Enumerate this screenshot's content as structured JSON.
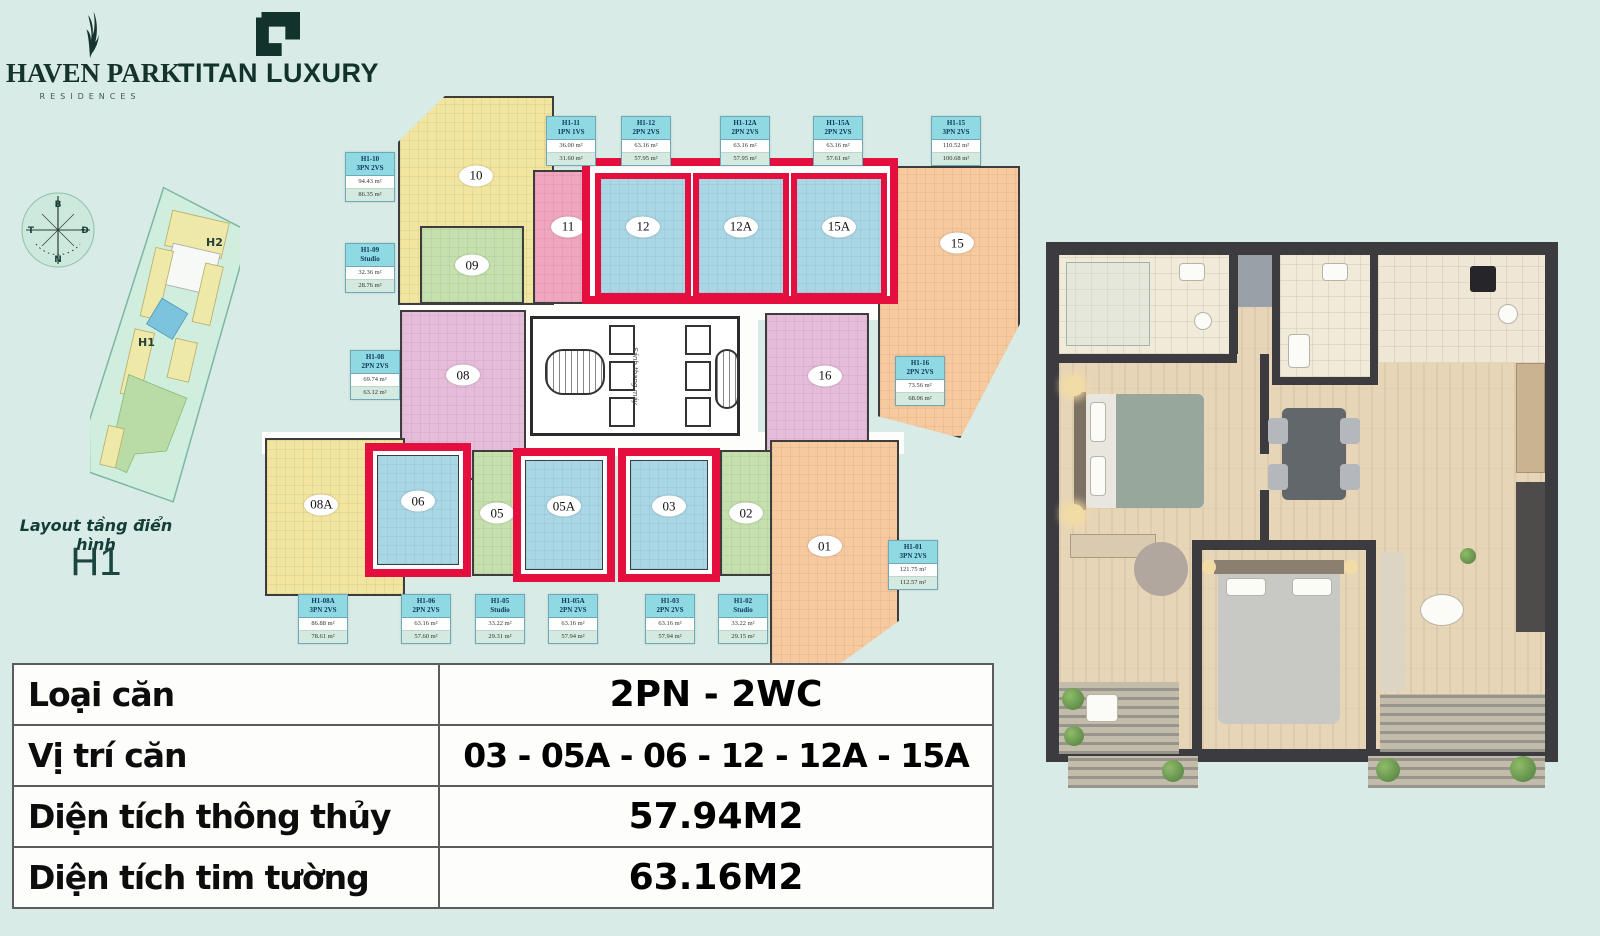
{
  "header": {
    "haven_park": {
      "title": "HAVEN PARK",
      "subtitle": "RESIDENCES"
    },
    "titan": {
      "title": "TITAN LUXURY"
    }
  },
  "left_panel": {
    "compass": {
      "n": "B",
      "e": "Đ",
      "s": "N",
      "w": "T"
    },
    "site_map": {
      "block_h2": "H2",
      "block_h1": "H1"
    },
    "caption": "Layout tầng điển hình",
    "block_name": "H1"
  },
  "plan": {
    "core_label": "Sảnh thang máy",
    "units": [
      {
        "number": "10",
        "color": "yellow",
        "highlighted": false
      },
      {
        "number": "09",
        "color": "green",
        "highlighted": false
      },
      {
        "number": "11",
        "color": "pink",
        "highlighted": false
      },
      {
        "number": "12",
        "color": "blue",
        "highlighted": true
      },
      {
        "number": "12A",
        "color": "blue",
        "highlighted": true
      },
      {
        "number": "15A",
        "color": "blue",
        "highlighted": true
      },
      {
        "number": "15",
        "color": "orange",
        "highlighted": false
      },
      {
        "number": "08",
        "color": "purple",
        "highlighted": false
      },
      {
        "number": "16",
        "color": "purple",
        "highlighted": false
      },
      {
        "number": "08A",
        "color": "yellow",
        "highlighted": false
      },
      {
        "number": "06",
        "color": "blue",
        "highlighted": true
      },
      {
        "number": "05",
        "color": "green",
        "highlighted": false
      },
      {
        "number": "05A",
        "color": "blue",
        "highlighted": true
      },
      {
        "number": "03",
        "color": "blue",
        "highlighted": true
      },
      {
        "number": "02",
        "color": "green",
        "highlighted": false
      },
      {
        "number": "01",
        "color": "orange",
        "highlighted": false
      }
    ],
    "badges": [
      {
        "code": "H1-10",
        "type": "3PN 2VS",
        "area_gross": "94.43 m²",
        "area_net": "86.35 m²"
      },
      {
        "code": "H1-09",
        "type": "Studio",
        "area_gross": "32.36 m²",
        "area_net": "28.76 m²"
      },
      {
        "code": "H1-08",
        "type": "2PN 2VS",
        "area_gross": "69.74 m²",
        "area_net": "63.12 m²"
      },
      {
        "code": "H1-11",
        "type": "1PN 1VS",
        "area_gross": "36.00 m²",
        "area_net": "31.60 m²"
      },
      {
        "code": "H1-12",
        "type": "2PN 2VS",
        "area_gross": "63.16 m²",
        "area_net": "57.95 m²"
      },
      {
        "code": "H1-12A",
        "type": "2PN 2VS",
        "area_gross": "63.16 m²",
        "area_net": "57.95 m²"
      },
      {
        "code": "H1-15A",
        "type": "2PN 2VS",
        "area_gross": "63.16 m²",
        "area_net": "57.61 m²"
      },
      {
        "code": "H1-15",
        "type": "3PN 2VS",
        "area_gross": "110.52 m²",
        "area_net": "100.68 m²"
      },
      {
        "code": "H1-16",
        "type": "2PN 2VS",
        "area_gross": "73.56 m²",
        "area_net": "68.06 m²"
      },
      {
        "code": "H1-01",
        "type": "3PN 2VS",
        "area_gross": "121.75 m²",
        "area_net": "112.57 m²"
      },
      {
        "code": "H1-08A",
        "type": "3PN 2VS",
        "area_gross": "86.88 m²",
        "area_net": "78.61 m²"
      },
      {
        "code": "H1-06",
        "type": "2PN 2VS",
        "area_gross": "63.16 m²",
        "area_net": "57.60 m²"
      },
      {
        "code": "H1-05",
        "type": "Studio",
        "area_gross": "33.22 m²",
        "area_net": "29.31 m²"
      },
      {
        "code": "H1-05A",
        "type": "2PN 2VS",
        "area_gross": "63.16 m²",
        "area_net": "57.94 m²"
      },
      {
        "code": "H1-03",
        "type": "2PN 2VS",
        "area_gross": "63.16 m²",
        "area_net": "57.94 m²"
      },
      {
        "code": "H1-02",
        "type": "Studio",
        "area_gross": "33.22 m²",
        "area_net": "29.15 m²"
      }
    ]
  },
  "summary_table": {
    "rows": [
      {
        "label": "Loại căn",
        "value": "2PN - 2WC"
      },
      {
        "label": "Vị trí căn",
        "value": "03 - 05A - 06 - 12 - 12A - 15A"
      },
      {
        "label": "Diện tích thông thủy",
        "value": "57.94M2"
      },
      {
        "label": "Diện tích tim tường",
        "value": "63.16M2"
      }
    ]
  },
  "colors": {
    "background": "#d8ebe6",
    "highlight_red": "#e50f3f",
    "unit_blue": "#aad7e6",
    "unit_yellow": "#f2e5a0",
    "unit_green": "#c6e0ad",
    "unit_pink": "#f1a6c0",
    "unit_purple": "#e5bcd9",
    "unit_orange": "#f7c99e",
    "badge_teal": "#8ed9e2",
    "brand_dark": "#15322c"
  }
}
